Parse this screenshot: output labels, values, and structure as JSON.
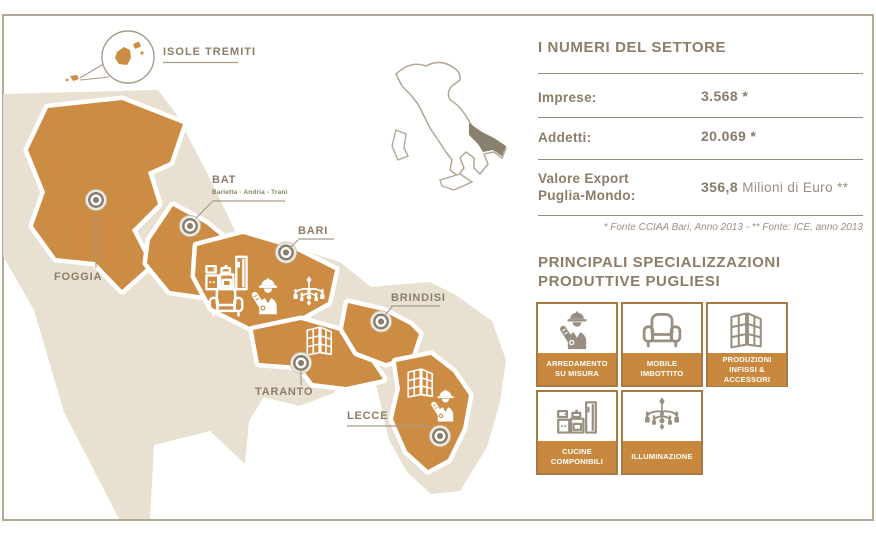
{
  "map": {
    "callout_label": "ISOLE TREMITI",
    "provinces": [
      {
        "id": "foggia",
        "label": "FOGGIA"
      },
      {
        "id": "bat",
        "label": "BAT",
        "sublabel": "Barletta - Andria - Trani"
      },
      {
        "id": "bari",
        "label": "BARI"
      },
      {
        "id": "brindisi",
        "label": "BRINDISI"
      },
      {
        "id": "taranto",
        "label": "TARANTO"
      },
      {
        "id": "lecce",
        "label": "LECCE"
      }
    ]
  },
  "stats": {
    "title": "I NUMERI DEL SETTORE",
    "rows": [
      {
        "label": "Imprese:",
        "value": "3.568 *"
      },
      {
        "label": "Addetti:",
        "value": "20.069 *"
      },
      {
        "label_line1": "Valore Export",
        "label_line2": "Puglia-Mondo:",
        "value_strong": "356,8",
        "value_rest": " Milioni di Euro **"
      }
    ],
    "footnote": "* Fonte CCIAA Bari, Anno 2013 - ** Fonte: ICE, anno 2013"
  },
  "specializations": {
    "title_line1": "PRINCIPALI SPECIALIZZAZIONI",
    "title_line2": "PRODUTTIVE PUGLIESI",
    "items": [
      {
        "icon": "worker-icon",
        "label": "ARREDAMENTO SU MISURA"
      },
      {
        "icon": "armchair-icon",
        "label": "MOBILE IMBOTTITO"
      },
      {
        "icon": "window-icon",
        "label": "PRODUZIONI INFISSI & ACCESSORI"
      },
      {
        "icon": "kitchen-icon",
        "label": "CUCINE COMPONIBILI"
      },
      {
        "icon": "chandelier-icon",
        "label": "ILLUMINAZIONE"
      }
    ]
  },
  "colors": {
    "province_orange": "#cd8c44",
    "band_orange": "#c8893f",
    "land_beige": "#e8e1d2",
    "text_taupe": "#8c7d66",
    "box_border": "#a87943",
    "frame_border": "#b3a795"
  }
}
